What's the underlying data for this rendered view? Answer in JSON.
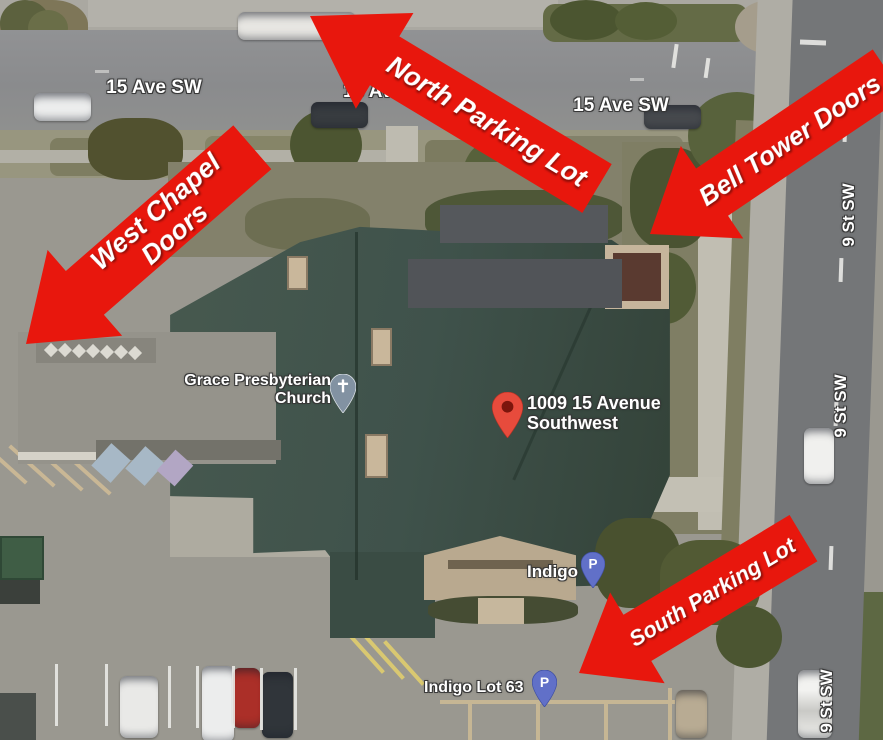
{
  "annotations": {
    "north_parking": "North Parking Lot",
    "bell_tower": "Bell Tower Doors",
    "west_chapel": {
      "line1": "West Chapel",
      "line2": "Doors"
    },
    "south_parking": "South Parking Lot"
  },
  "streets": {
    "ave15": "15 Ave SW",
    "st9": "9 St SW"
  },
  "pois": {
    "church": {
      "line1": "Grace Presbyterian",
      "line2": "Church"
    },
    "address": {
      "line1": "1009 15 Avenue",
      "line2": "Southwest"
    },
    "indigo": {
      "label": "Indigo",
      "pin_letter": "P"
    },
    "indigo_lot63": {
      "label": "Indigo Lot 63",
      "pin_letter": "P"
    }
  },
  "colors": {
    "annotation_red": "#e8170d",
    "annotation_text": "#ffffff",
    "roof_green": "#3f524b",
    "red_pin": "#e74b3c",
    "parking_pin_blue": "#6170c8",
    "church_pin_gray": "#8292a2"
  }
}
